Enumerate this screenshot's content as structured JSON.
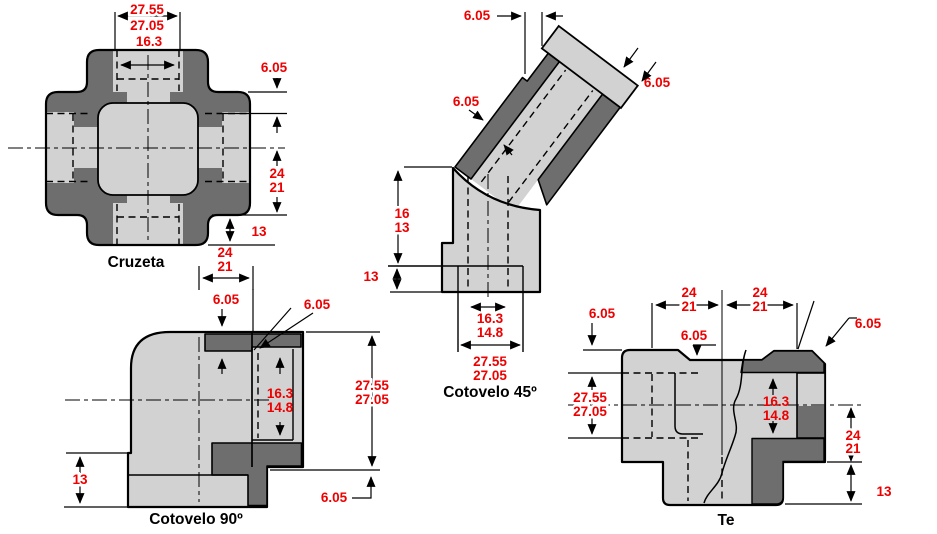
{
  "palette": {
    "body_light": "#d2d2d2",
    "body_dark": "#6e6e6e",
    "outline": "#000000",
    "dimension_text": "#ee0000",
    "name_text": "#000000",
    "background": "#ffffff"
  },
  "fittings": {
    "cruzeta": {
      "label": "Cruzeta",
      "dims": {
        "width_a": "27.55",
        "width_b": "27.05",
        "bore": "16.3",
        "wall": "6.05",
        "half_a": "24",
        "half_b": "21",
        "thread": "13",
        "bottom_a": "24",
        "bottom_b": "21"
      }
    },
    "cotovelo45": {
      "label": "Cotovelo 45º",
      "dims": {
        "step": "6.05",
        "cap": "6.05",
        "wall": "6.05",
        "height_a": "16",
        "height_b": "13",
        "base": "13",
        "bore_a": "16.3",
        "bore_b": "14.8",
        "width_a": "27.55",
        "width_b": "27.05"
      }
    },
    "cotovelo90": {
      "label": "Cotovelo 90º",
      "dims": {
        "top": "6.05",
        "corner": "6.05",
        "bore_a": "16.3",
        "bore_b": "14.8",
        "height_a": "27.55",
        "height_b": "27.05",
        "base": "13",
        "lip": "6.05"
      }
    },
    "te": {
      "label": "Te",
      "dims": {
        "left_a": "24",
        "left_b": "21",
        "right_a": "24",
        "right_b": "21",
        "edge": "6.05",
        "center": "6.05",
        "corner": "6.05",
        "height_a": "27.55",
        "height_b": "27.05",
        "bore_a": "16.3",
        "bore_b": "14.8",
        "side_a": "24",
        "side_b": "21",
        "base": "13"
      }
    }
  }
}
